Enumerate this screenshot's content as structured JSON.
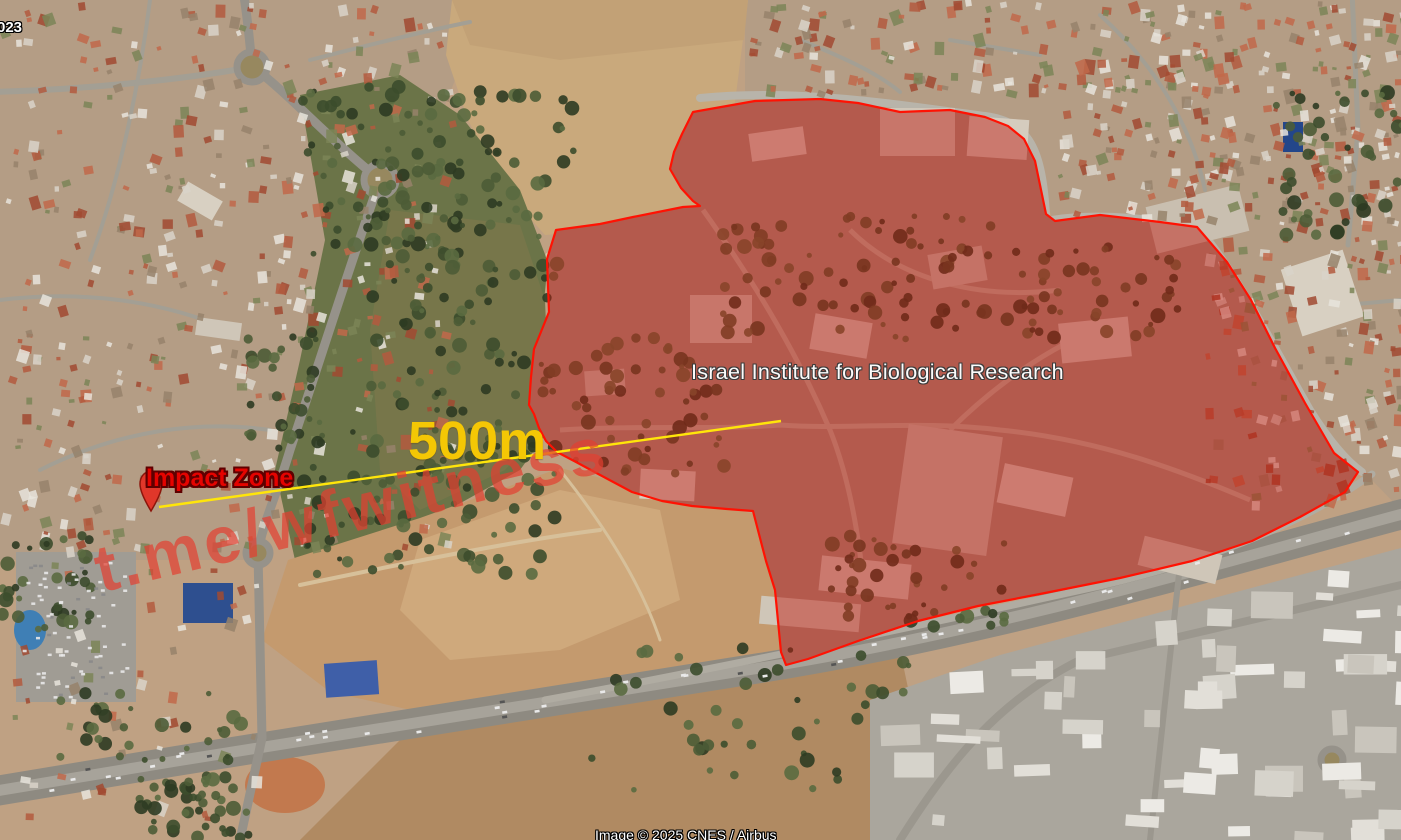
{
  "map": {
    "date_fragment": "023",
    "watermark": "t.me/wfwitness",
    "attribution": "Image © 2025 CNES / Airbus"
  },
  "annotations": {
    "zone": {
      "label": "Israel Institute for Biological Research",
      "fill_color": "#c01910",
      "fill_opacity": 0.46,
      "stroke_color": "#ff1203",
      "points": [
        [
          693,
          112
        ],
        [
          755,
          101
        ],
        [
          820,
          99
        ],
        [
          858,
          103
        ],
        [
          900,
          112
        ],
        [
          950,
          110
        ],
        [
          985,
          117
        ],
        [
          1008,
          126
        ],
        [
          1024,
          139
        ],
        [
          1035,
          161
        ],
        [
          1040,
          185
        ],
        [
          1046,
          214
        ],
        [
          1055,
          221
        ],
        [
          1100,
          215
        ],
        [
          1160,
          222
        ],
        [
          1197,
          227
        ],
        [
          1227,
          262
        ],
        [
          1251,
          300
        ],
        [
          1275,
          348
        ],
        [
          1305,
          403
        ],
        [
          1334,
          453
        ],
        [
          1358,
          472
        ],
        [
          1345,
          492
        ],
        [
          1300,
          517
        ],
        [
          1252,
          541
        ],
        [
          1192,
          561
        ],
        [
          1120,
          578
        ],
        [
          1040,
          594
        ],
        [
          978,
          606
        ],
        [
          918,
          621
        ],
        [
          858,
          641
        ],
        [
          808,
          659
        ],
        [
          786,
          665
        ],
        [
          781,
          652
        ],
        [
          775,
          590
        ],
        [
          766,
          561
        ],
        [
          753,
          511
        ],
        [
          727,
          509
        ],
        [
          692,
          506
        ],
        [
          662,
          501
        ],
        [
          632,
          492
        ],
        [
          602,
          476
        ],
        [
          576,
          462
        ],
        [
          557,
          452
        ],
        [
          546,
          441
        ],
        [
          539,
          428
        ],
        [
          534,
          414
        ],
        [
          529,
          405
        ],
        [
          531,
          377
        ],
        [
          534,
          349
        ],
        [
          549,
          312
        ],
        [
          547,
          259
        ],
        [
          556,
          230
        ],
        [
          600,
          224
        ],
        [
          633,
          217
        ],
        [
          683,
          207
        ],
        [
          700,
          206
        ],
        [
          693,
          201
        ],
        [
          681,
          188
        ],
        [
          670,
          169
        ],
        [
          674,
          152
        ],
        [
          682,
          134
        ]
      ]
    },
    "measurement": {
      "label": "500m",
      "label_color": "#f4c705",
      "line_color": "#ffe50a",
      "from": [
        159,
        507
      ],
      "to": [
        781,
        421
      ]
    },
    "impact": {
      "label": "Impact Zone",
      "label_color": "#e50300",
      "pin_color": "#e0372a",
      "pin_tip": [
        151,
        511
      ]
    }
  }
}
